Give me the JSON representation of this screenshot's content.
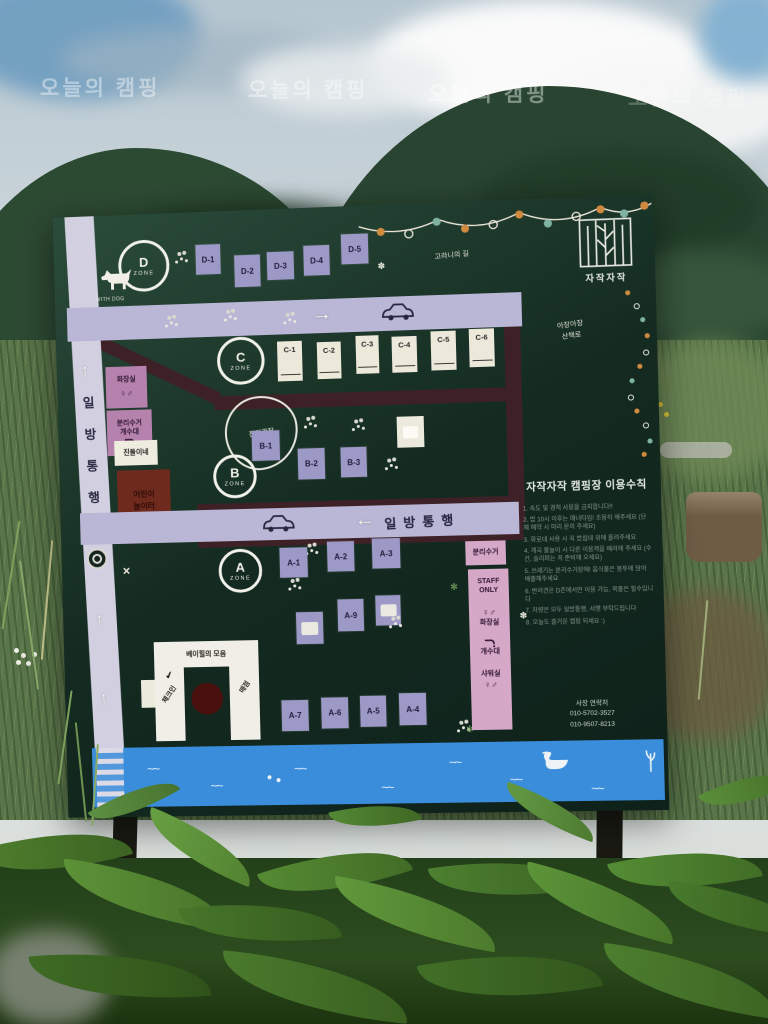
{
  "watermark": {
    "text": "오늘의 캠핑"
  },
  "board": {
    "logo": {
      "title": "자작자작"
    },
    "paths": {
      "deer": "고라니의 길",
      "walk1": "아장아장",
      "walk2": "산책로"
    },
    "roads": {
      "vchars": [
        "일",
        "방",
        "통",
        "행"
      ],
      "one_way_mid": "일방통행",
      "up": "↑",
      "right": "→",
      "left": "←",
      "no_entry": "✕"
    },
    "zones": {
      "d": {
        "letter": "D",
        "zone": "ZONE",
        "with_dog": "WITH DOG",
        "sites": [
          "D-1",
          "D-2",
          "D-3",
          "D-4",
          "D-5"
        ]
      },
      "c": {
        "letter": "C",
        "zone": "ZONE",
        "sites": [
          "C-1",
          "C-2",
          "C-3",
          "C-4",
          "C-5",
          "C-6"
        ]
      },
      "b": {
        "letter": "B",
        "zone": "ZONE",
        "sites": [
          "B-1",
          "B-2",
          "B-3"
        ]
      },
      "a": {
        "letter": "A",
        "zone": "ZONE",
        "row1": [
          "A-1",
          "A-2",
          "A-3"
        ],
        "row2": [
          "A-9"
        ],
        "row3": [
          "A-7",
          "A-6",
          "A-5",
          "A-4"
        ]
      }
    },
    "facilities": {
      "toilet_left": "화장실",
      "recycle_left": "분리수거",
      "sink_left": "개수대",
      "jindol": "진돌이네",
      "playground_1": "어린이",
      "playground_2": "놀이터",
      "lawn": "잔디광장",
      "recycle_right": "분리수거",
      "staff_1": "STAFF",
      "staff_2": "ONLY",
      "toilet_right": "화장실",
      "sink_right": "개수대",
      "shower": "샤워실",
      "gender": "♀♂",
      "checkin_title": "베이힐의 모음",
      "checkin": "체크인",
      "checkmark": "✔",
      "store": "매점"
    },
    "rules": {
      "title": "자작자작 캠핑장 이용수칙",
      "lines": [
        "1. 속도 및 경적 사용을 금지합니다!!",
        "2. 밤 10시 이후는 매너타임! 조용히 해주세요 (단체 예약 시 미리 문의 주세요)",
        "3. 화로대 사용 시 꼭 받침대 위에 올려주세요",
        "4. 계곡 물놀이 시 다른 이용객을 배려해 주세요 (수건, 슬리퍼는 꼭 준비해 오세요)",
        "5. 쓰레기는 분리수거장에! 음식물은 봉투에 담아 배출해주세요",
        "6. 반려견은 D존에서만 이용 가능, 목줄은 필수입니다",
        "7. 차량은 모두 일방통행, 서행 부탁드립니다",
        "8. 오늘도 즐거운 캠핑 되세요 :)"
      ],
      "contact_label": "사장 연락처",
      "phone1": "010-5702-3527",
      "phone2": "010-9507-8213"
    }
  }
}
